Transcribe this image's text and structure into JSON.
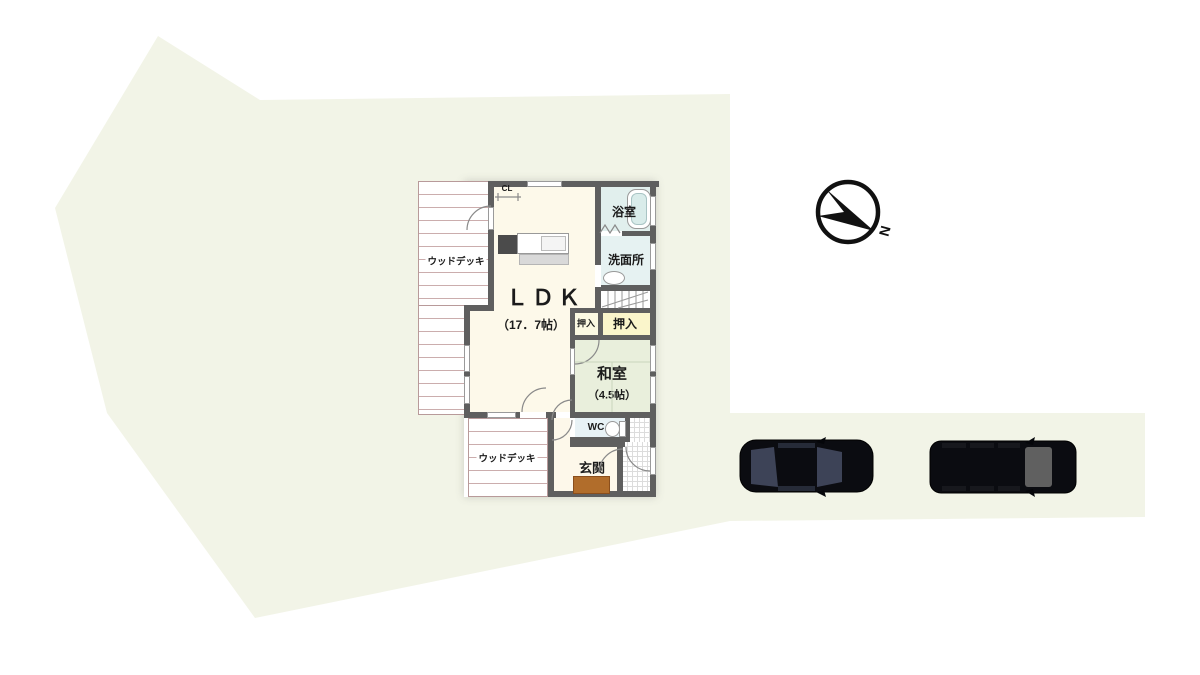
{
  "title": "site floor plan",
  "compass": {
    "north_label": "N"
  },
  "plan": {
    "ldk": {
      "name": "ＬＤＫ",
      "size": "（17．7帖）"
    },
    "washitsu": {
      "name": "和室",
      "size": "（4.5帖）"
    },
    "bath": {
      "name": "浴室"
    },
    "washroom": {
      "name": "洗面所"
    },
    "closet_left": {
      "name": "押入"
    },
    "closet_right": {
      "name": "押入"
    },
    "closet_cl": {
      "name": "CL"
    },
    "wc": {
      "name": "WC"
    },
    "entrance": {
      "name": "玄関"
    },
    "deck_top": {
      "name": "ウッドデッキ"
    },
    "deck_bottom": {
      "name": "ウッドデッキ"
    }
  },
  "site": {
    "parked_cars": 2
  },
  "colors": {
    "site-fill": "#f2f4e7",
    "wall": "#5f5f5f",
    "ldk-fill": "#fdf9ea",
    "bath-fill": "#e1efed",
    "washroom-fill": "#e6f2f2",
    "closet-left-fill": "#fbf9e2",
    "closet-right-fill": "#faf5cb",
    "washitsu-fill": "#e9efdc",
    "wc-fill": "#e8f2f6",
    "entrance-fill": "#fdf8ea",
    "mat-fill": "#b16d2b",
    "deck-line": "#cbadad",
    "car-body": "#0b0c11",
    "car-glass": "#3d4357",
    "car-glass2": "#606060"
  }
}
